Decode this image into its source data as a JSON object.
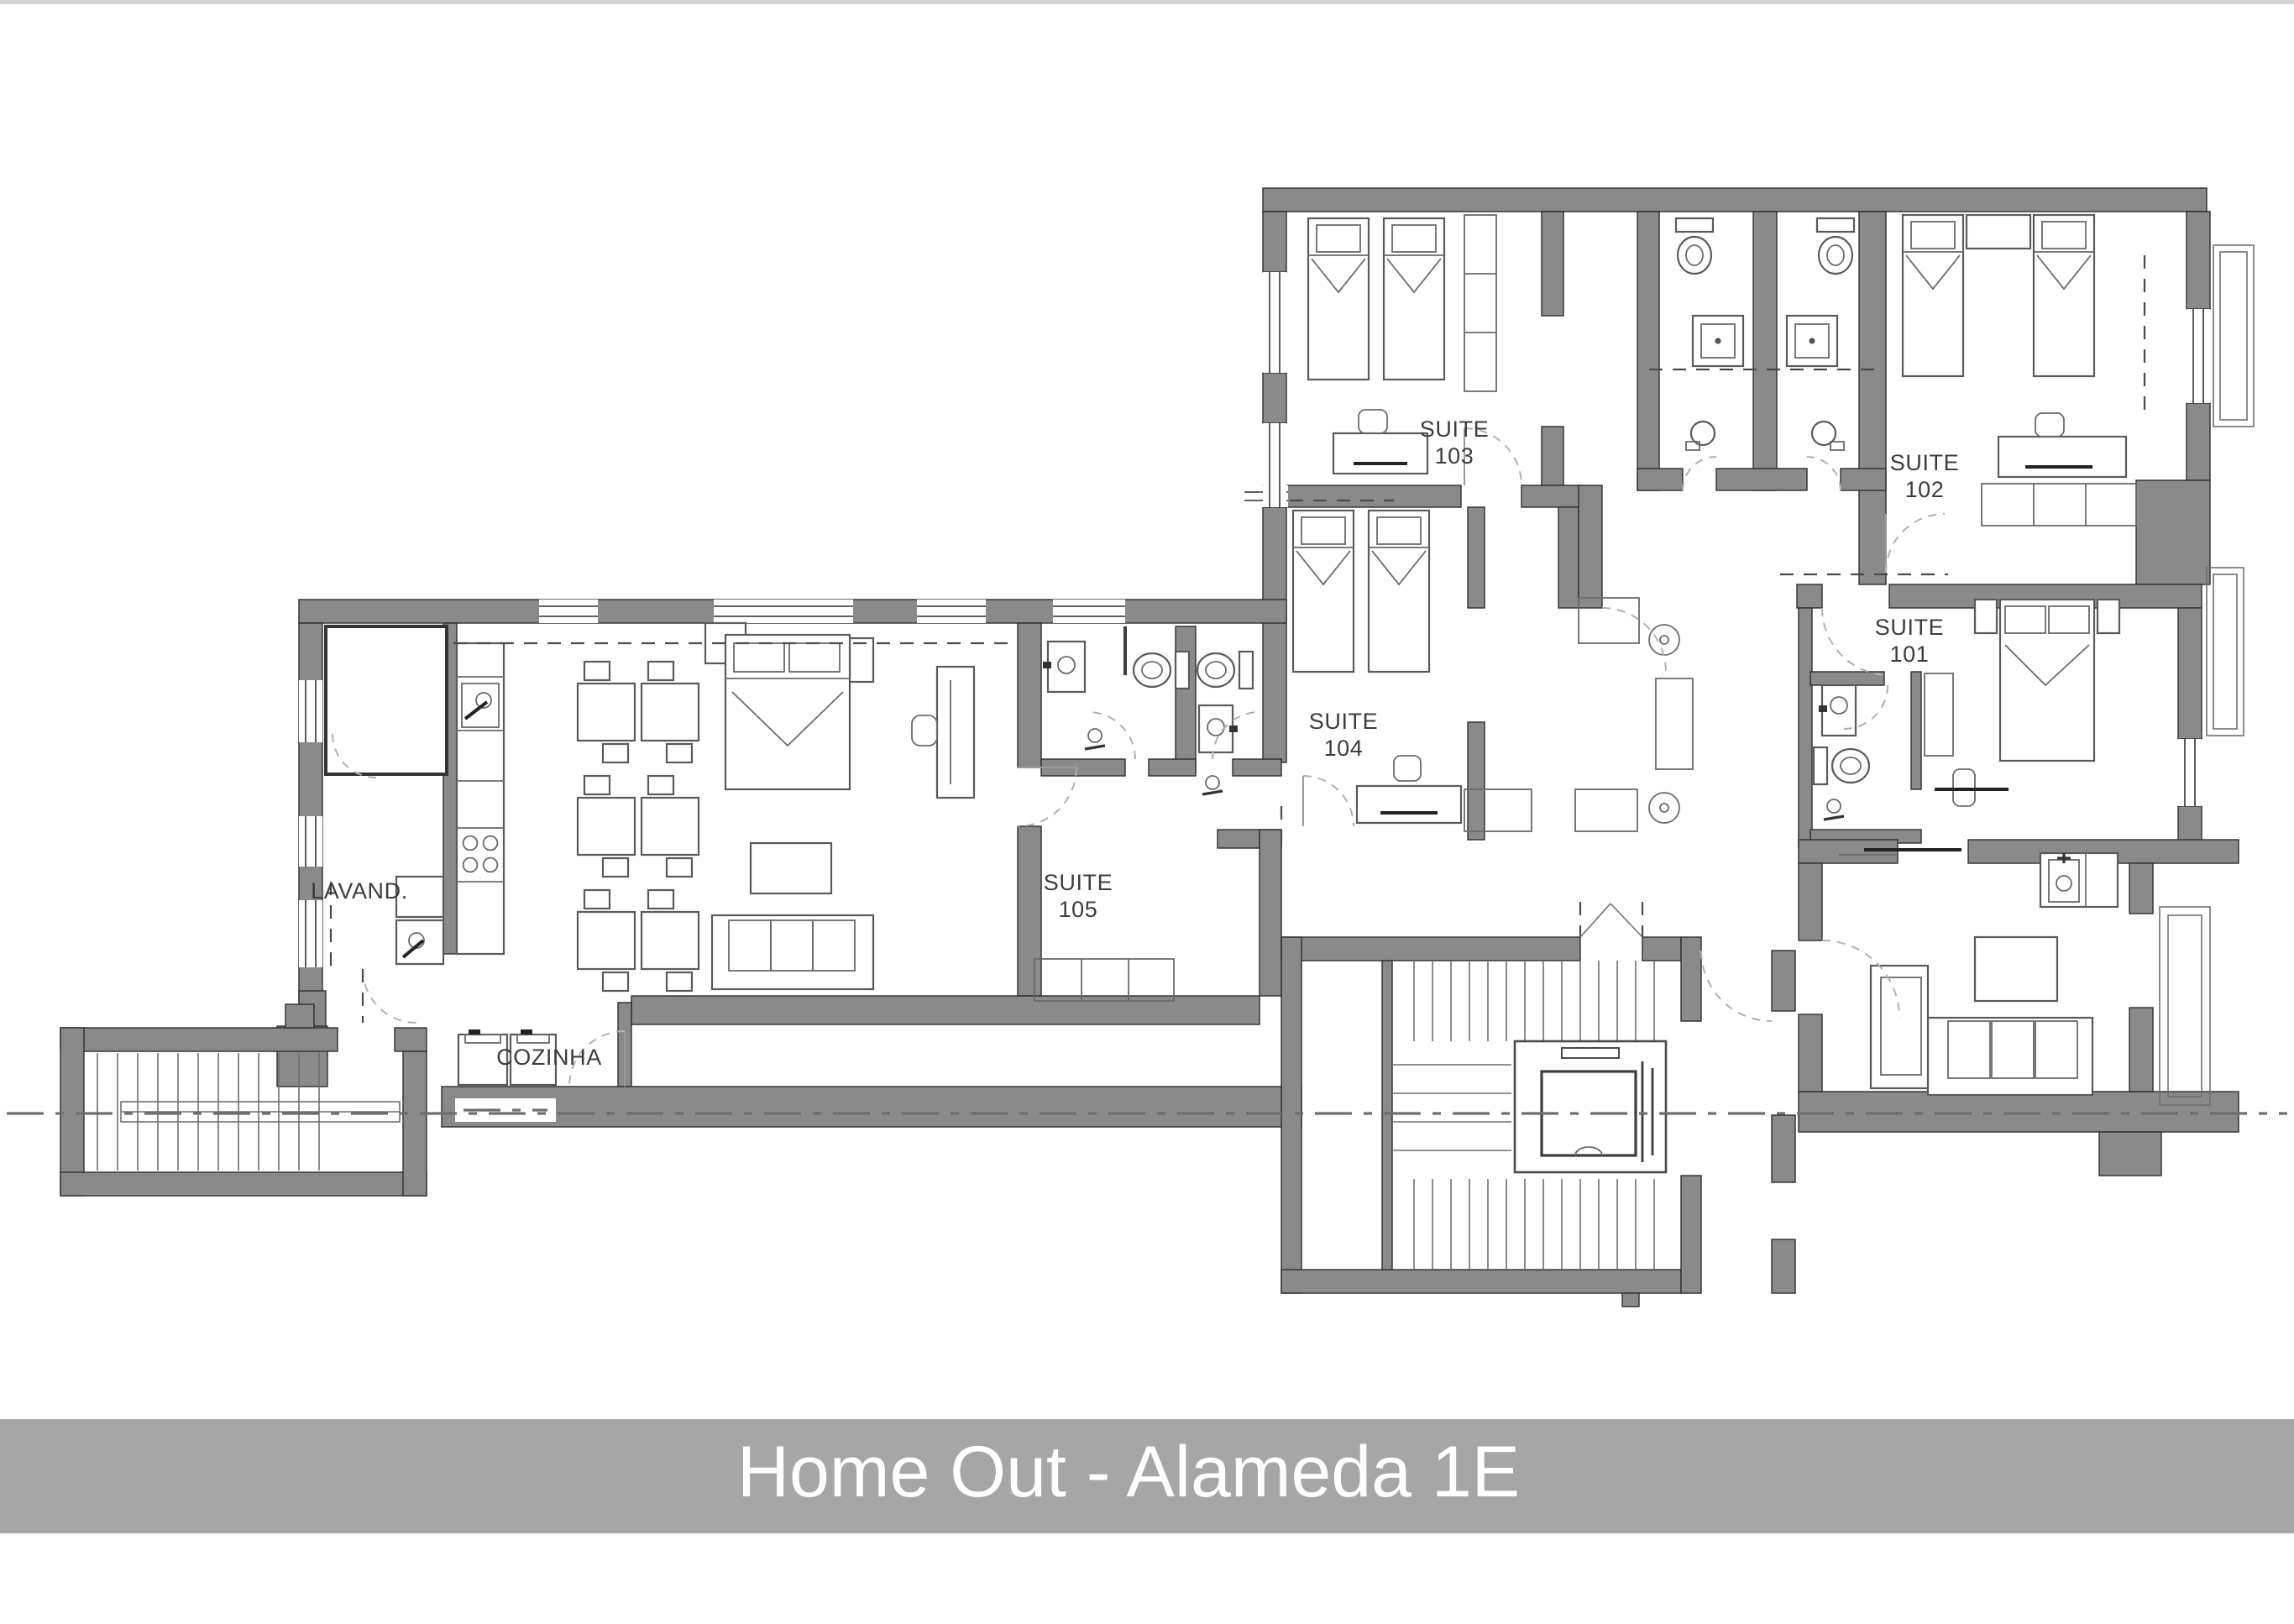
{
  "title_bar": {
    "text": "Home Out - Alameda 1E",
    "background": "#a6a6a6",
    "text_color": "#ffffff"
  },
  "plan": {
    "wall_color": "#8a8a8a",
    "outline_color": "#2e2e2e",
    "furniture_line_color": "#5a5a5a",
    "rooms": {
      "suite101": {
        "line1": "SUITE",
        "line2": "101"
      },
      "suite102": {
        "line1": "SUITE",
        "line2": "102"
      },
      "suite103": {
        "line1": "SUITE",
        "line2": "103"
      },
      "suite104": {
        "line1": "SUITE",
        "line2": "104"
      },
      "suite105": {
        "line1": "SUITE",
        "line2": "105"
      },
      "laundry": {
        "label": "LAVAND."
      },
      "kitchen": {
        "label": "COZINHA"
      }
    }
  }
}
